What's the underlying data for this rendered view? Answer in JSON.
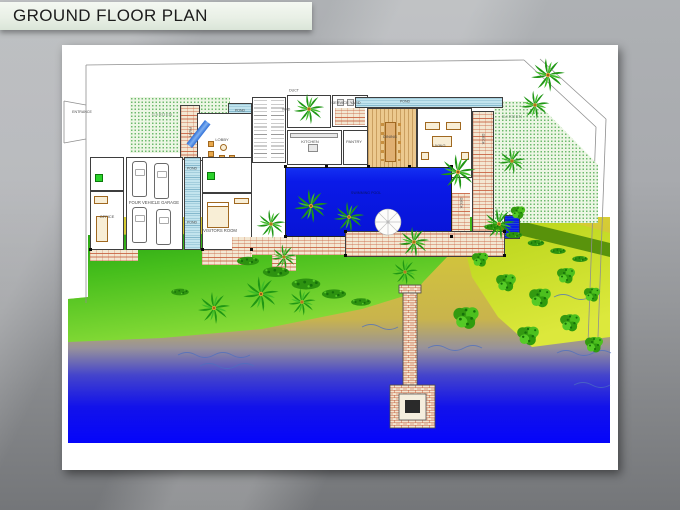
{
  "title": "GROUND FLOOR PLAN",
  "plan": {
    "labels": {
      "entrance": "ENTRANCE",
      "garden_left": "GARDEN",
      "garden_right": "GARDEN",
      "duct": "DUCT",
      "void": "VOID",
      "service_yard": "SERVICE YARD",
      "kitchen": "KITCHEN",
      "pantry": "PANTRY",
      "dining": "DINING",
      "living": "LIVING",
      "lobby": "LOBBY",
      "path": "PATH",
      "pond_a": "POND",
      "pond_b": "POND",
      "pond_c": "POND",
      "pond_d": "POND",
      "deck_right": "DECK",
      "deck_lower": "DECK",
      "office": "OFFICE",
      "garage": "FOUR VEHICLE GARAGE",
      "visitors": "VISITORS ROOM",
      "pool": "SWIMMING POOL"
    },
    "colors": {
      "pool_blue": "#0a1ae8",
      "sea_deep": "#0505fa",
      "beach_yellow": "#d2c838",
      "lawn_green": "#0d8f0d",
      "garden_dot_green": "#6bb86b",
      "brick_red": "#c75f3e",
      "titlebar_green": "#e9f0e6"
    }
  }
}
